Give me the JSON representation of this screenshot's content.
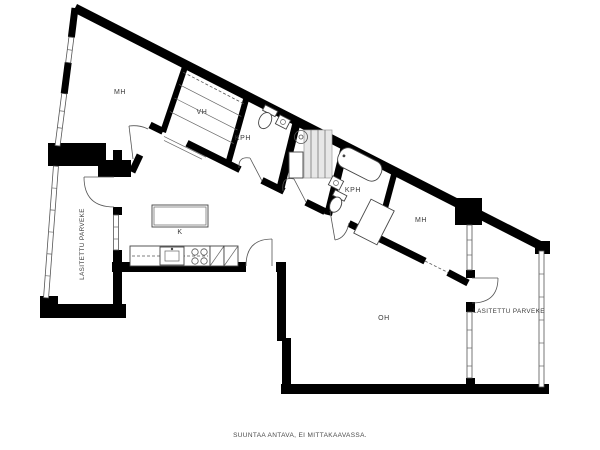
{
  "floorplan": {
    "rooms": {
      "bedroom_left": "MH",
      "closet": "VH",
      "bathroom_left": "KPH",
      "bathroom_right": "KPH",
      "bedroom_right": "MH",
      "kitchen": "K",
      "living_room": "OH",
      "balcony_left": "LASITETTU PARVEKE",
      "balcony_right": "LASITETTU PARVEKE"
    },
    "footer_note": "SUUNTAA ANTAVA, EI MITTAKAAVASSA.",
    "colors": {
      "wall": "#000000",
      "background": "#ffffff",
      "shaft_fill": "#e7e7e7",
      "label_text": "#3a3a3a"
    }
  }
}
